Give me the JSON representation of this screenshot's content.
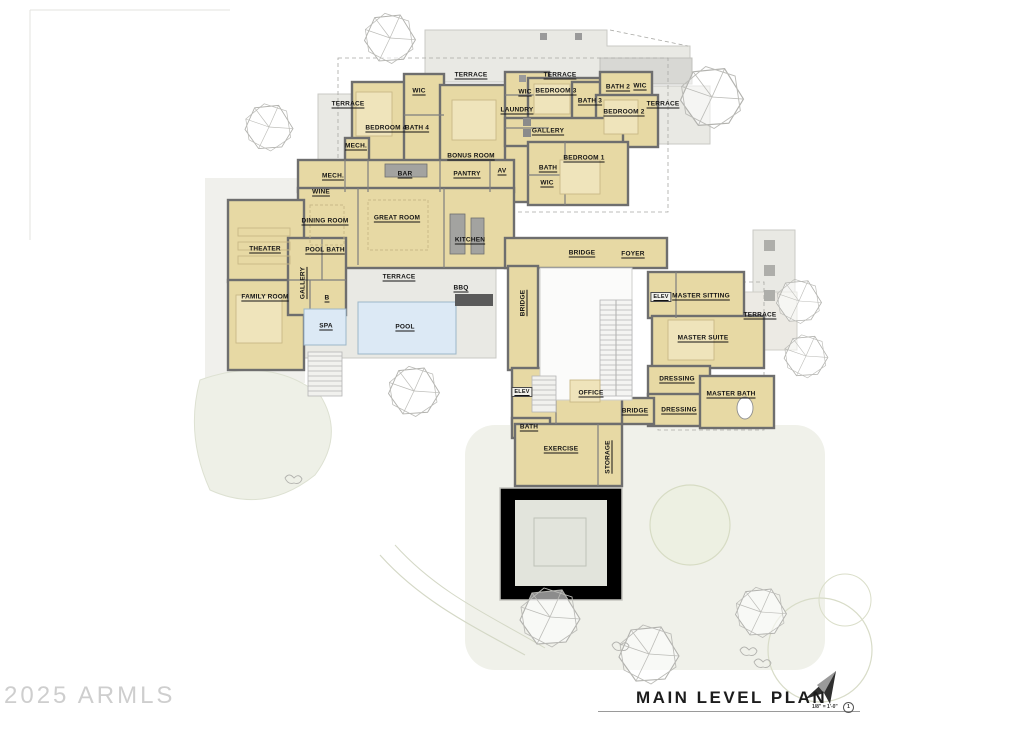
{
  "watermark": "2025 ARMLS",
  "title_block": {
    "title": "MAIN LEVEL PLAN",
    "scale": "1/8\" = 1'-0\"",
    "detail_number": "1"
  },
  "colors": {
    "room_fill": "#e7d9a4",
    "room_fill_light": "#efe4bb",
    "wall": "#6e6e6e",
    "pool_water": "#dce9f5",
    "site_gray": "#e9e9e4",
    "lawn_green": "#eef0e7",
    "tree_stroke": "#b2b2ae"
  },
  "labels": {
    "terrace_nw": "TERRACE",
    "wic_bed4": "WIC",
    "bedroom4": "BEDROOM 4",
    "bath4": "BATH 4",
    "mech_upper": "MECH.",
    "terrace_top_center": "TERRACE",
    "bonus_room": "BONUS ROOM",
    "wic_bed3": "WIC",
    "laundry": "LAUNDRY",
    "terrace_top_right": "TERRACE",
    "bedroom3": "BEDROOM 3",
    "bath3": "BATH 3",
    "bath2": "BATH 2",
    "wic_bed2": "WIC",
    "bedroom2": "BEDROOM 2",
    "terrace_east": "TERRACE",
    "gallery_upper": "GALLERY",
    "bedroom1": "BEDROOM 1",
    "bath_bed1": "BATH",
    "wic_bed1": "WIC",
    "mech_main": "MECH.",
    "wine": "WINE",
    "bar": "BAR",
    "pantry": "PANTRY",
    "av": "AV",
    "dining_room": "DINING ROOM",
    "great_room": "GREAT ROOM",
    "kitchen": "KITCHEN",
    "theater": "THEATER",
    "pool_bath": "POOL BATH",
    "powder": "B",
    "gallery_lower": "GALLERY",
    "family_room": "FAMILY ROOM",
    "terrace_pool": "TERRACE",
    "bbq": "BBQ",
    "spa": "SPA",
    "pool": "POOL",
    "bridge_main": "BRIDGE",
    "foyer": "FOYER",
    "bridge_west": "BRIDGE",
    "elev_master": "ELEV",
    "master_sitting": "MASTER SITTING",
    "terrace_master": "TERRACE",
    "master_suite": "MASTER SUITE",
    "dressing_a": "DRESSING",
    "master_bath": "MASTER BATH",
    "dressing_b": "DRESSING",
    "elev_office": "ELEV",
    "office": "OFFICE",
    "bridge_office": "BRIDGE",
    "bath_office": "BATH",
    "exercise": "EXERCISE",
    "storage": "STORAGE"
  }
}
